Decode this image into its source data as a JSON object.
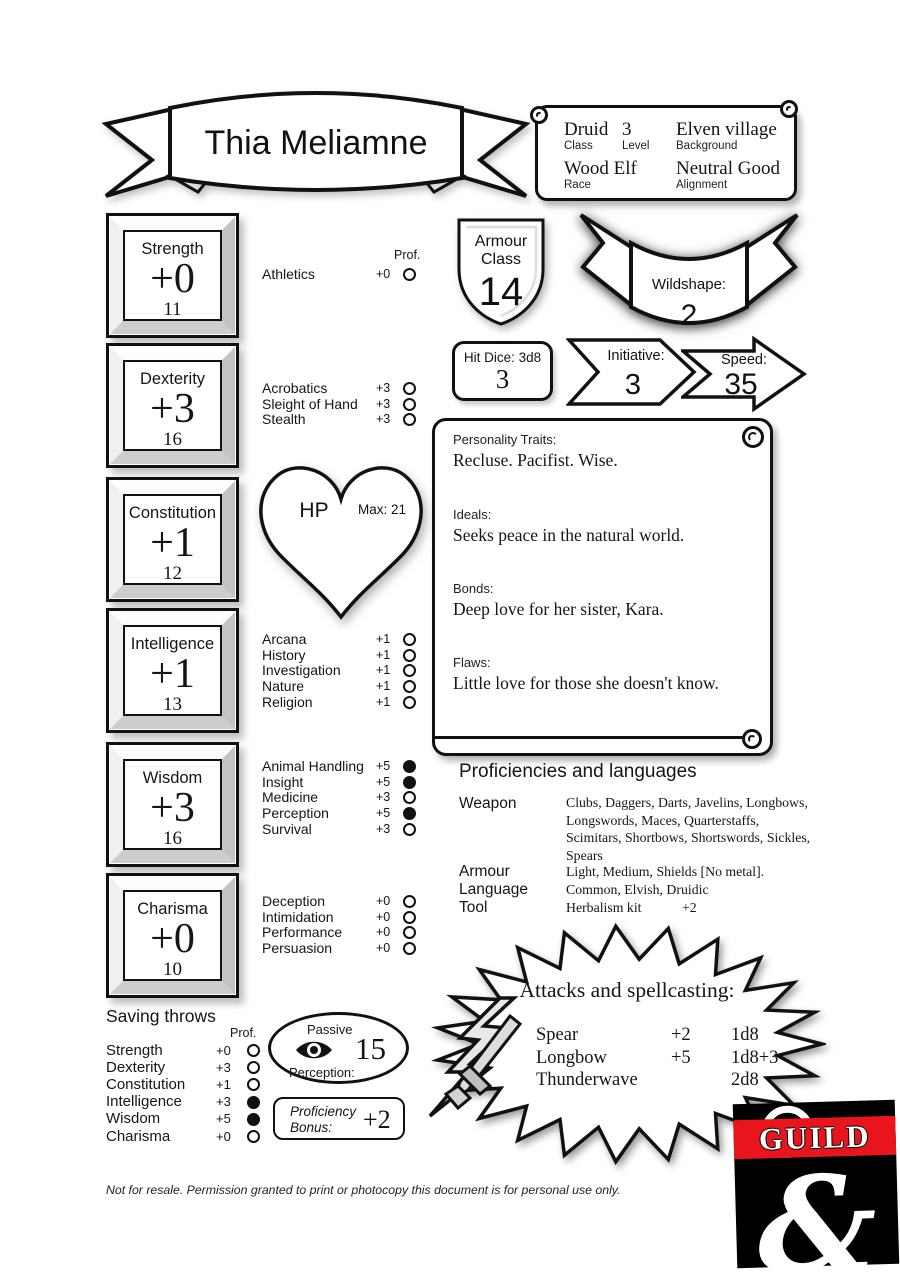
{
  "header": {
    "name": "Thia Meliamne",
    "info": {
      "class_value": "Druid",
      "class_label": "Class",
      "level_value": "3",
      "level_label": "Level",
      "background_value": "Elven village",
      "background_label": "Background",
      "race_value": "Wood Elf",
      "race_label": "Race",
      "alignment_value": "Neutral Good",
      "alignment_label": "Alignment"
    }
  },
  "labels": {
    "prof": "Prof."
  },
  "abilities": [
    {
      "name": "Strength",
      "mod": "+0",
      "score": "11"
    },
    {
      "name": "Dexterity",
      "mod": "+3",
      "score": "16"
    },
    {
      "name": "Constitution",
      "mod": "+1",
      "score": "12"
    },
    {
      "name": "Intelligence",
      "mod": "+1",
      "score": "13"
    },
    {
      "name": "Wisdom",
      "mod": "+3",
      "score": "16"
    },
    {
      "name": "Charisma",
      "mod": "+0",
      "score": "10"
    }
  ],
  "skills": {
    "strength": [
      {
        "name": "Athletics",
        "mod": "+0",
        "prof": false
      }
    ],
    "dexterity": [
      {
        "name": "Acrobatics",
        "mod": "+3",
        "prof": false
      },
      {
        "name": "Sleight of Hand",
        "mod": "+3",
        "prof": false
      },
      {
        "name": "Stealth",
        "mod": "+3",
        "prof": false
      }
    ],
    "intelligence": [
      {
        "name": "Arcana",
        "mod": "+1",
        "prof": false
      },
      {
        "name": "History",
        "mod": "+1",
        "prof": false
      },
      {
        "name": "Investigation",
        "mod": "+1",
        "prof": false
      },
      {
        "name": "Nature",
        "mod": "+1",
        "prof": false
      },
      {
        "name": "Religion",
        "mod": "+1",
        "prof": false
      }
    ],
    "wisdom": [
      {
        "name": "Animal Handling",
        "mod": "+5",
        "prof": true
      },
      {
        "name": "Insight",
        "mod": "+5",
        "prof": true
      },
      {
        "name": "Medicine",
        "mod": "+3",
        "prof": false
      },
      {
        "name": "Perception",
        "mod": "+5",
        "prof": true
      },
      {
        "name": "Survival",
        "mod": "+3",
        "prof": false
      }
    ],
    "charisma": [
      {
        "name": "Deception",
        "mod": "+0",
        "prof": false
      },
      {
        "name": "Intimidation",
        "mod": "+0",
        "prof": false
      },
      {
        "name": "Performance",
        "mod": "+0",
        "prof": false
      },
      {
        "name": "Persuasion",
        "mod": "+0",
        "prof": false
      }
    ]
  },
  "combat": {
    "armour_class": {
      "label_line1": "Armour",
      "label_line2": "Class",
      "value": "14"
    },
    "wildshape": {
      "label": "Wildshape:",
      "value": "2"
    },
    "hit_dice": {
      "label": "Hit Dice: 3d8",
      "value": "3"
    },
    "initiative": {
      "label": "Initiative:",
      "value": "3"
    },
    "speed": {
      "label": "Speed:",
      "value": "35"
    },
    "hp": {
      "label": "HP",
      "max": "Max: 21"
    }
  },
  "personality": {
    "traits": {
      "label": "Personality Traits:",
      "text": "Recluse. Pacifist. Wise."
    },
    "ideals": {
      "label": "Ideals:",
      "text": "Seeks peace in the natural world."
    },
    "bonds": {
      "label": "Bonds:",
      "text": "Deep love for her sister, Kara."
    },
    "flaws": {
      "label": "Flaws:",
      "text": "Little love for those she doesn't know."
    }
  },
  "proficiencies": {
    "title": "Proficiencies and languages",
    "weapon_label": "Weapon",
    "weapon_value": "Clubs, Daggers, Darts, Javelins, Longbows, Longswords, Maces, Quarterstaffs, Scimitars, Shortbows, Shortswords, Sickles, Spears",
    "armour_label": "Armour",
    "armour_value": "Light, Medium, Shields [No metal].",
    "language_label": "Language",
    "language_value": "Common, Elvish, Druidic",
    "tool_label": "Tool",
    "tool_value": "Herbalism kit",
    "tool_bonus": "+2"
  },
  "attacks": {
    "title": "Attacks and spellcasting:",
    "rows": [
      {
        "name": "Spear",
        "bonus": "+2",
        "damage": "1d8"
      },
      {
        "name": "Longbow",
        "bonus": "+5",
        "damage": "1d8+3"
      },
      {
        "name": "Thunderwave",
        "bonus": "",
        "damage": "2d8"
      }
    ]
  },
  "saving_throws": {
    "title": "Saving throws",
    "rows": [
      {
        "name": "Strength",
        "mod": "+0",
        "prof": false
      },
      {
        "name": "Dexterity",
        "mod": "+3",
        "prof": false
      },
      {
        "name": "Constitution",
        "mod": "+1",
        "prof": false
      },
      {
        "name": "Intelligence",
        "mod": "+3",
        "prof": true
      },
      {
        "name": "Wisdom",
        "mod": "+5",
        "prof": true
      },
      {
        "name": "Charisma",
        "mod": "+0",
        "prof": false
      }
    ]
  },
  "passive_perception": {
    "label_line1": "Passive",
    "label_line2": "Perception:",
    "value": "15"
  },
  "proficiency_bonus": {
    "label_line1": "Proficiency",
    "label_line2": "Bonus:",
    "value": "+2"
  },
  "logo": {
    "text": "GUILD"
  },
  "footer": "Not for resale. Permission granted to print or photocopy this document is for personal use only.",
  "colors": {
    "ink": "#151515",
    "logo_red": "#e8151c"
  }
}
